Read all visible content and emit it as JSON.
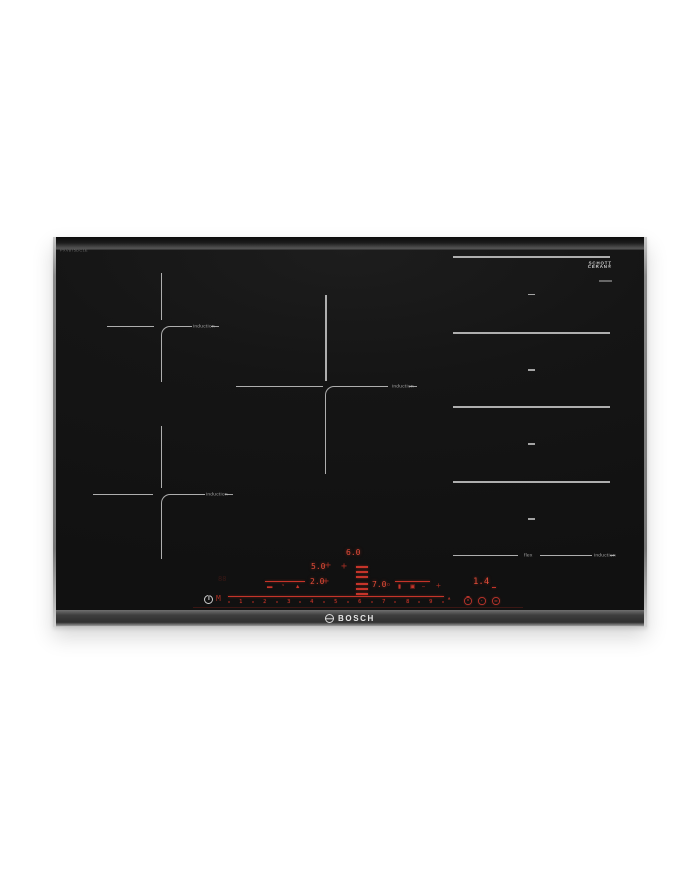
{
  "product": {
    "brand_label": "BOSCH",
    "model_text": "PXV875DC1E",
    "badge_line1": "SCHOTT",
    "badge_line2": "CERAN®"
  },
  "zones": {
    "zone_label": "induction",
    "flex_mid_label": "flex",
    "flex_end_label": "induction"
  },
  "display": {
    "zone_top_left_power": "5.0",
    "zone_center_power": "6.0",
    "zone_bottom_left_power": "2.0",
    "zone_flex_power": "7.0",
    "degree_mark": "o",
    "timer_value": "1.4",
    "ghost_segments": "88",
    "move_label": "M",
    "plus_label": "+",
    "cross_mark": "+",
    "slider_levels": [
      "1",
      "2",
      "3",
      "4",
      "5",
      "6",
      "7",
      "8",
      "9"
    ]
  },
  "icons": {
    "left_fn": [
      "▬",
      "◔",
      "▲"
    ],
    "right_fn": [
      "▮",
      "▣",
      "–"
    ],
    "end_marker": "▴"
  },
  "colors": {
    "led_red": "#e04b38",
    "zone_line_gray": "#c4c4c4",
    "glass_black": "#141414"
  }
}
